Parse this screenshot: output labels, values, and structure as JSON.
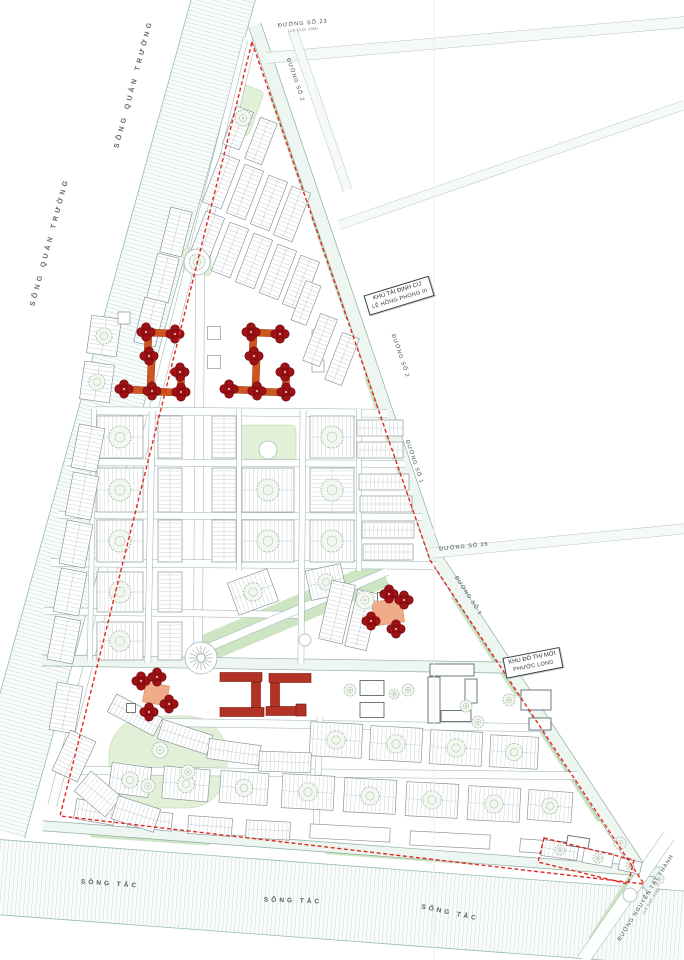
{
  "title": "Urban master plan – Phuoc Long new town area",
  "colors": {
    "block_fill": "#ffffff",
    "block_stroke": "#8b969c",
    "hatch": "#b6c0c4",
    "road_fill": "#fdfefe",
    "road_edge": "#a0acb0",
    "faint_fill": "#f5faf7",
    "faint_edge": "#b7c2c6",
    "major_fill": "#edf6f1",
    "major_edge": "#8fae9f",
    "river_fill": "#f8fcfa",
    "river_tick": "#bcc9cb",
    "river_edge": "#97bcae",
    "park_fill": "#e2f0d8",
    "park_stroke": "#bcd9ad",
    "green_strip": "#cde5c2",
    "tower_fill": "#9e1115",
    "tower_stroke": "#6d090c",
    "podium_orange": "#cf5520",
    "podium_salmon": "#f0ac88",
    "school_fill": "#b23226",
    "school_stroke": "#77150e",
    "outline_stroke": "#5c6a72",
    "tree_stroke": "#96a89a",
    "boundary_red": "#e02a20",
    "fold": "#edeff1"
  },
  "labels": [
    {
      "id": "river-quan-truong-1",
      "text": "SÔNG QUÁN TRƯỜNG",
      "x": 134,
      "y": 84,
      "rot": -75,
      "cls": "river"
    },
    {
      "id": "river-quan-truong-2",
      "text": "SÔNG QUÁN TRƯỜNG",
      "x": 50,
      "y": 242,
      "rot": -75,
      "cls": "river"
    },
    {
      "id": "song-tac-1",
      "text": "SÔNG TẮC",
      "x": 110,
      "y": 884,
      "rot": 4,
      "cls": "tac"
    },
    {
      "id": "song-tac-2",
      "text": "SÔNG TẮC",
      "x": 293,
      "y": 901,
      "rot": 2,
      "cls": "tac"
    },
    {
      "id": "song-tac-3",
      "text": "SÔNG TẮC",
      "x": 450,
      "y": 913,
      "rot": 12,
      "cls": "tac"
    },
    {
      "id": "duong-so-23",
      "text": "ĐƯỜNG SỐ 23",
      "sub": "(LỘ GIỚI 30M)",
      "x": 303,
      "y": 26,
      "rot": -5,
      "cls": "road"
    },
    {
      "id": "duong-so-2-a",
      "text": "ĐƯỜNG SỐ 2",
      "x": 295,
      "y": 80,
      "rot": 71,
      "cls": "road"
    },
    {
      "id": "duong-so-2-b",
      "text": "ĐƯỜNG SỐ 2",
      "x": 400,
      "y": 356,
      "rot": 71,
      "cls": "road"
    },
    {
      "id": "duong-so-1-a",
      "text": "ĐƯỜNG SỐ 1",
      "x": 414,
      "y": 462,
      "rot": 71,
      "cls": "road"
    },
    {
      "id": "duong-so-26",
      "text": "ĐƯỜNG SỐ 26",
      "x": 464,
      "y": 547,
      "rot": -6,
      "cls": "road"
    },
    {
      "id": "duong-so-1-b",
      "text": "ĐƯỜNG SỐ 1",
      "x": 468,
      "y": 596,
      "rot": 57,
      "cls": "road"
    },
    {
      "id": "duong-nguyen-tat-thanh",
      "text": "ĐƯỜNG NGUYỄN TẤT THÀNH",
      "sub": "(LỘ GIỚI 60M)",
      "x": 648,
      "y": 899,
      "rot": -58,
      "cls": "road"
    },
    {
      "id": "khu-tai-dinh-cu",
      "text": "KHU TÁI ĐỊNH CƯ",
      "sub": "LÊ HỒNG PHONG III",
      "x": 399,
      "y": 296,
      "rot": -17,
      "cls": "box"
    },
    {
      "id": "khu-do-thi-moi",
      "text": "KHU ĐÔ THỊ MỚI",
      "sub": "PHƯỚC LONG",
      "x": 533,
      "y": 663,
      "rot": -11,
      "cls": "box"
    }
  ],
  "map": {
    "site": "256,28 436,558 652,888 45,818",
    "rivers": [
      [
        113,
        400,
        892,
        62,
        105.4
      ],
      [
        330,
        902,
        710,
        75,
        4.3
      ]
    ],
    "roads": [
      [
        150,
        422,
        792,
        9,
        104.3,
        0
      ],
      [
        346,
        293,
        566,
        13,
        71.2,
        2
      ],
      [
        544,
        723,
        400,
        13,
        56.8,
        2
      ],
      [
        352,
        849,
        620,
        10,
        4.3,
        2
      ],
      [
        626,
        898,
        150,
        13,
        -55.3,
        0
      ],
      [
        476,
        40,
        420,
        11,
        -4.9,
        1
      ],
      [
        320,
        110,
        170,
        9,
        71,
        1
      ],
      [
        512,
        165,
        366,
        9,
        -19.2,
        1
      ],
      [
        558,
        541,
        256,
        10,
        -5.5,
        1
      ],
      [
        225,
        153,
        228,
        8,
        103.4,
        0
      ],
      [
        199,
        460,
        388,
        9,
        90.3,
        0
      ],
      [
        274,
        664,
        464,
        11,
        0.9,
        2
      ],
      [
        241,
        412,
        292,
        8,
        0.5,
        0
      ],
      [
        236,
        463,
        337,
        7,
        0.3,
        0
      ],
      [
        240,
        516,
        363,
        7,
        0.3,
        0
      ],
      [
        244,
        564,
        387,
        8,
        0.4,
        0
      ],
      [
        173,
        613,
        258,
        7,
        0.9,
        0
      ],
      [
        348,
        725,
        398,
        8,
        0.8,
        0
      ],
      [
        318,
        773,
        519,
        8,
        0.6,
        0
      ],
      [
        292,
        612,
        208,
        8,
        -23,
        0
      ],
      [
        92,
        535,
        252,
        5,
        91,
        0
      ],
      [
        150,
        537,
        252,
        6,
        91,
        0
      ],
      [
        239,
        490,
        162,
        5,
        90,
        0
      ],
      [
        302,
        537,
        254,
        6,
        90.5,
        0
      ],
      [
        359,
        490,
        162,
        5,
        90,
        0
      ],
      [
        318,
        775,
        116,
        6,
        92,
        0
      ]
    ],
    "greens": [
      [
        292,
        612,
        200,
        28,
        -23
      ],
      [
        288,
        144,
        110,
        4.5,
        71
      ],
      [
        330,
        267,
        110,
        4.5,
        71
      ],
      [
        384,
        428,
        110,
        4.5,
        71
      ],
      [
        485,
        646,
        120,
        4.5,
        57
      ],
      [
        567,
        771,
        120,
        4.5,
        57
      ],
      [
        150,
        839,
        120,
        5,
        4
      ],
      [
        400,
        857,
        150,
        5,
        4
      ],
      [
        612,
        906,
        80,
        5,
        -57
      ]
    ],
    "parks": [
      [
        244,
        110,
        26,
        48,
        20,
        5
      ],
      [
        197,
        262,
        28,
        28,
        0,
        4
      ],
      [
        268,
        445,
        56,
        40,
        0,
        5
      ],
      [
        168,
        762,
        118,
        92,
        0,
        40
      ],
      [
        250,
        664,
        120,
        6,
        0,
        2
      ],
      [
        470,
        669,
        108,
        6,
        0,
        2
      ]
    ],
    "blocks": [
      [
        238,
        128,
        18,
        40,
        21
      ],
      [
        261,
        141,
        18,
        44,
        21
      ],
      [
        221,
        181,
        20,
        52,
        21
      ],
      [
        245,
        192,
        20,
        52,
        21
      ],
      [
        269,
        203,
        20,
        52,
        21
      ],
      [
        292,
        214,
        20,
        52,
        21
      ],
      [
        206,
        239,
        20,
        52,
        21
      ],
      [
        230,
        250,
        20,
        52,
        21
      ],
      [
        254,
        261,
        20,
        52,
        21
      ],
      [
        278,
        272,
        20,
        52,
        21
      ],
      [
        301,
        283,
        20,
        52,
        21
      ],
      [
        306,
        303,
        16,
        42,
        21
      ],
      [
        176,
        232,
        22,
        46,
        14
      ],
      [
        163,
        278,
        22,
        46,
        14
      ],
      [
        150,
        322,
        22,
        46,
        14
      ],
      [
        104,
        336,
        30,
        38,
        8
      ],
      [
        97,
        382,
        30,
        38,
        8
      ],
      [
        214,
        333,
        13,
        13,
        0
      ],
      [
        214,
        362,
        13,
        13,
        0
      ],
      [
        124,
        318,
        12,
        12,
        0
      ],
      [
        318,
        336,
        12,
        12,
        0
      ],
      [
        318,
        366,
        12,
        12,
        0
      ],
      [
        320,
        340,
        18,
        50,
        21
      ],
      [
        342,
        359,
        18,
        50,
        21
      ],
      [
        120,
        437,
        46,
        42,
        0
      ],
      [
        120,
        490,
        46,
        44,
        0
      ],
      [
        120,
        541,
        46,
        42,
        0
      ],
      [
        120,
        592,
        46,
        40,
        0
      ],
      [
        120,
        641,
        46,
        38,
        0
      ],
      [
        170,
        437,
        24,
        42,
        0
      ],
      [
        170,
        490,
        24,
        44,
        0
      ],
      [
        170,
        541,
        24,
        42,
        0
      ],
      [
        170,
        592,
        24,
        40,
        0
      ],
      [
        170,
        641,
        24,
        38,
        0
      ],
      [
        224,
        437,
        24,
        42,
        0
      ],
      [
        224,
        490,
        24,
        44,
        0
      ],
      [
        224,
        541,
        24,
        42,
        0
      ],
      [
        268,
        490,
        52,
        44,
        0
      ],
      [
        268,
        541,
        52,
        42,
        0
      ],
      [
        332,
        437,
        44,
        42,
        0
      ],
      [
        332,
        490,
        44,
        44,
        0
      ],
      [
        332,
        541,
        44,
        42,
        0
      ],
      [
        253,
        592,
        42,
        34,
        -20
      ],
      [
        326,
        582,
        36,
        30,
        -12
      ],
      [
        380,
        428,
        46,
        16,
        0
      ],
      [
        380,
        450,
        46,
        16,
        0
      ],
      [
        384,
        482,
        50,
        16,
        0
      ],
      [
        386,
        504,
        52,
        16,
        0
      ],
      [
        388,
        530,
        52,
        16,
        0
      ],
      [
        388,
        552,
        50,
        16,
        0
      ],
      [
        337,
        612,
        24,
        60,
        13
      ],
      [
        362,
        620,
        22,
        58,
        13
      ],
      [
        88,
        448,
        26,
        44,
        11
      ],
      [
        82,
        496,
        26,
        44,
        11
      ],
      [
        76,
        544,
        26,
        44,
        11
      ],
      [
        70,
        592,
        26,
        44,
        11
      ],
      [
        64,
        640,
        26,
        44,
        11
      ],
      [
        336,
        740,
        52,
        34,
        3
      ],
      [
        396,
        744,
        52,
        34,
        3
      ],
      [
        456,
        748,
        52,
        34,
        3
      ],
      [
        514,
        752,
        48,
        32,
        3
      ],
      [
        308,
        792,
        52,
        34,
        3
      ],
      [
        370,
        796,
        52,
        34,
        3
      ],
      [
        432,
        800,
        52,
        34,
        3
      ],
      [
        494,
        804,
        52,
        34,
        3
      ],
      [
        550,
        806,
        44,
        30,
        4
      ],
      [
        130,
        780,
        40,
        30,
        8
      ],
      [
        186,
        784,
        46,
        32,
        5
      ],
      [
        244,
        788,
        48,
        32,
        4
      ],
      [
        95,
        812,
        40,
        20,
        10
      ],
      [
        150,
        820,
        44,
        18,
        6
      ],
      [
        210,
        826,
        44,
        18,
        4
      ],
      [
        268,
        830,
        44,
        18,
        3
      ],
      [
        350,
        833,
        80,
        14,
        3
      ],
      [
        450,
        840,
        80,
        14,
        3
      ],
      [
        545,
        847,
        50,
        13,
        4
      ],
      [
        66,
        708,
        26,
        48,
        10
      ],
      [
        74,
        756,
        28,
        44,
        25
      ],
      [
        98,
        794,
        40,
        26,
        40
      ],
      [
        136,
        814,
        44,
        24,
        18
      ],
      [
        135,
        715,
        52,
        20,
        28
      ],
      [
        185,
        737,
        52,
        20,
        18
      ],
      [
        234,
        752,
        52,
        20,
        8
      ],
      [
        285,
        762,
        52,
        20,
        2
      ],
      [
        560,
        850,
        36,
        16,
        8
      ],
      [
        598,
        858,
        30,
        14,
        10
      ],
      [
        630,
        866,
        22,
        12,
        12
      ]
    ],
    "outlines": [
      [
        452,
        670,
        44,
        12,
        0
      ],
      [
        434,
        700,
        12,
        46,
        0
      ],
      [
        456,
        716,
        30,
        11,
        0
      ],
      [
        471,
        691,
        12,
        24,
        0
      ],
      [
        372,
        688,
        24,
        15,
        0
      ],
      [
        372,
        710,
        24,
        15,
        0
      ],
      [
        536,
        700,
        30,
        20,
        0
      ],
      [
        540,
        724,
        22,
        12,
        0
      ],
      [
        578,
        842,
        22,
        10,
        9
      ],
      [
        382,
        597,
        9,
        9,
        0
      ],
      [
        131,
        708,
        9,
        9,
        0
      ]
    ],
    "schools": [
      [
        241,
        677,
        42,
        9,
        0
      ],
      [
        256,
        697,
        9,
        30,
        0
      ],
      [
        242,
        712,
        44,
        9,
        0
      ],
      [
        290,
        678,
        42,
        9,
        0
      ],
      [
        275,
        697,
        9,
        28,
        0
      ],
      [
        286,
        711,
        40,
        9,
        0
      ],
      [
        301,
        710,
        10,
        12,
        0
      ]
    ],
    "podiums": [
      [
        161,
        333,
        28,
        7,
        2,
        0
      ],
      [
        148,
        345,
        7,
        22,
        2,
        0
      ],
      [
        139,
        390,
        28,
        7,
        2,
        0
      ],
      [
        166,
        392,
        28,
        7,
        2,
        0
      ],
      [
        151,
        374,
        7,
        28,
        2,
        0
      ],
      [
        181,
        382,
        7,
        18,
        2,
        0
      ],
      [
        266,
        333,
        28,
        7,
        2,
        0
      ],
      [
        253,
        345,
        7,
        22,
        2,
        0
      ],
      [
        244,
        390,
        28,
        7,
        2,
        0
      ],
      [
        271,
        392,
        28,
        7,
        2,
        0
      ],
      [
        256,
        374,
        7,
        28,
        2,
        0
      ],
      [
        286,
        382,
        7,
        18,
        2,
        0
      ],
      [
        388,
        612,
        30,
        24,
        -8,
        1
      ],
      [
        156,
        694,
        24,
        20,
        10,
        1
      ]
    ],
    "towers": [
      [
        146,
        332
      ],
      [
        175,
        334
      ],
      [
        149,
        356
      ],
      [
        124,
        389
      ],
      [
        152,
        391
      ],
      [
        180,
        372
      ],
      [
        181,
        392
      ],
      [
        251,
        332
      ],
      [
        280,
        334
      ],
      [
        254,
        356
      ],
      [
        229,
        389
      ],
      [
        257,
        391
      ],
      [
        285,
        372
      ],
      [
        286,
        392
      ],
      [
        389,
        594
      ],
      [
        404,
        600
      ],
      [
        371,
        621
      ],
      [
        396,
        629
      ],
      [
        141,
        681
      ],
      [
        157,
        677
      ],
      [
        169,
        704
      ],
      [
        149,
        712
      ]
    ],
    "trees": [
      [
        243,
        118,
        8,
        "tree"
      ],
      [
        197,
        262,
        13,
        "ring"
      ],
      [
        197,
        262,
        8,
        "tree"
      ],
      [
        201,
        658,
        16,
        "ring"
      ],
      [
        201,
        658,
        12,
        "burst"
      ],
      [
        305,
        640,
        6,
        "ring"
      ],
      [
        630,
        895,
        7,
        "ring"
      ],
      [
        365,
        600,
        9,
        "tree"
      ],
      [
        268,
        450,
        9,
        "pond"
      ],
      [
        160,
        750,
        8,
        "tree"
      ],
      [
        188,
        772,
        7,
        "tree"
      ],
      [
        148,
        786,
        7,
        "tree"
      ],
      [
        350,
        690,
        6,
        "tree"
      ],
      [
        408,
        690,
        6,
        "tree"
      ],
      [
        466,
        706,
        6,
        "tree"
      ],
      [
        478,
        722,
        6,
        "tree"
      ],
      [
        394,
        694,
        5,
        "tree"
      ],
      [
        560,
        850,
        5,
        "tree"
      ],
      [
        598,
        858,
        5,
        "tree"
      ],
      [
        630,
        866,
        4,
        "tree"
      ],
      [
        659,
        879,
        5,
        "tree"
      ],
      [
        620,
        843,
        6,
        "tree"
      ],
      [
        509,
        700,
        6,
        "tree"
      ]
    ],
    "boundaries": [
      "252,42 430,560 644,884 60,816",
      "544,838 634,860 628,884 538,862"
    ],
    "xlines": [
      [
        434,
        0,
        434,
        960
      ]
    ]
  }
}
